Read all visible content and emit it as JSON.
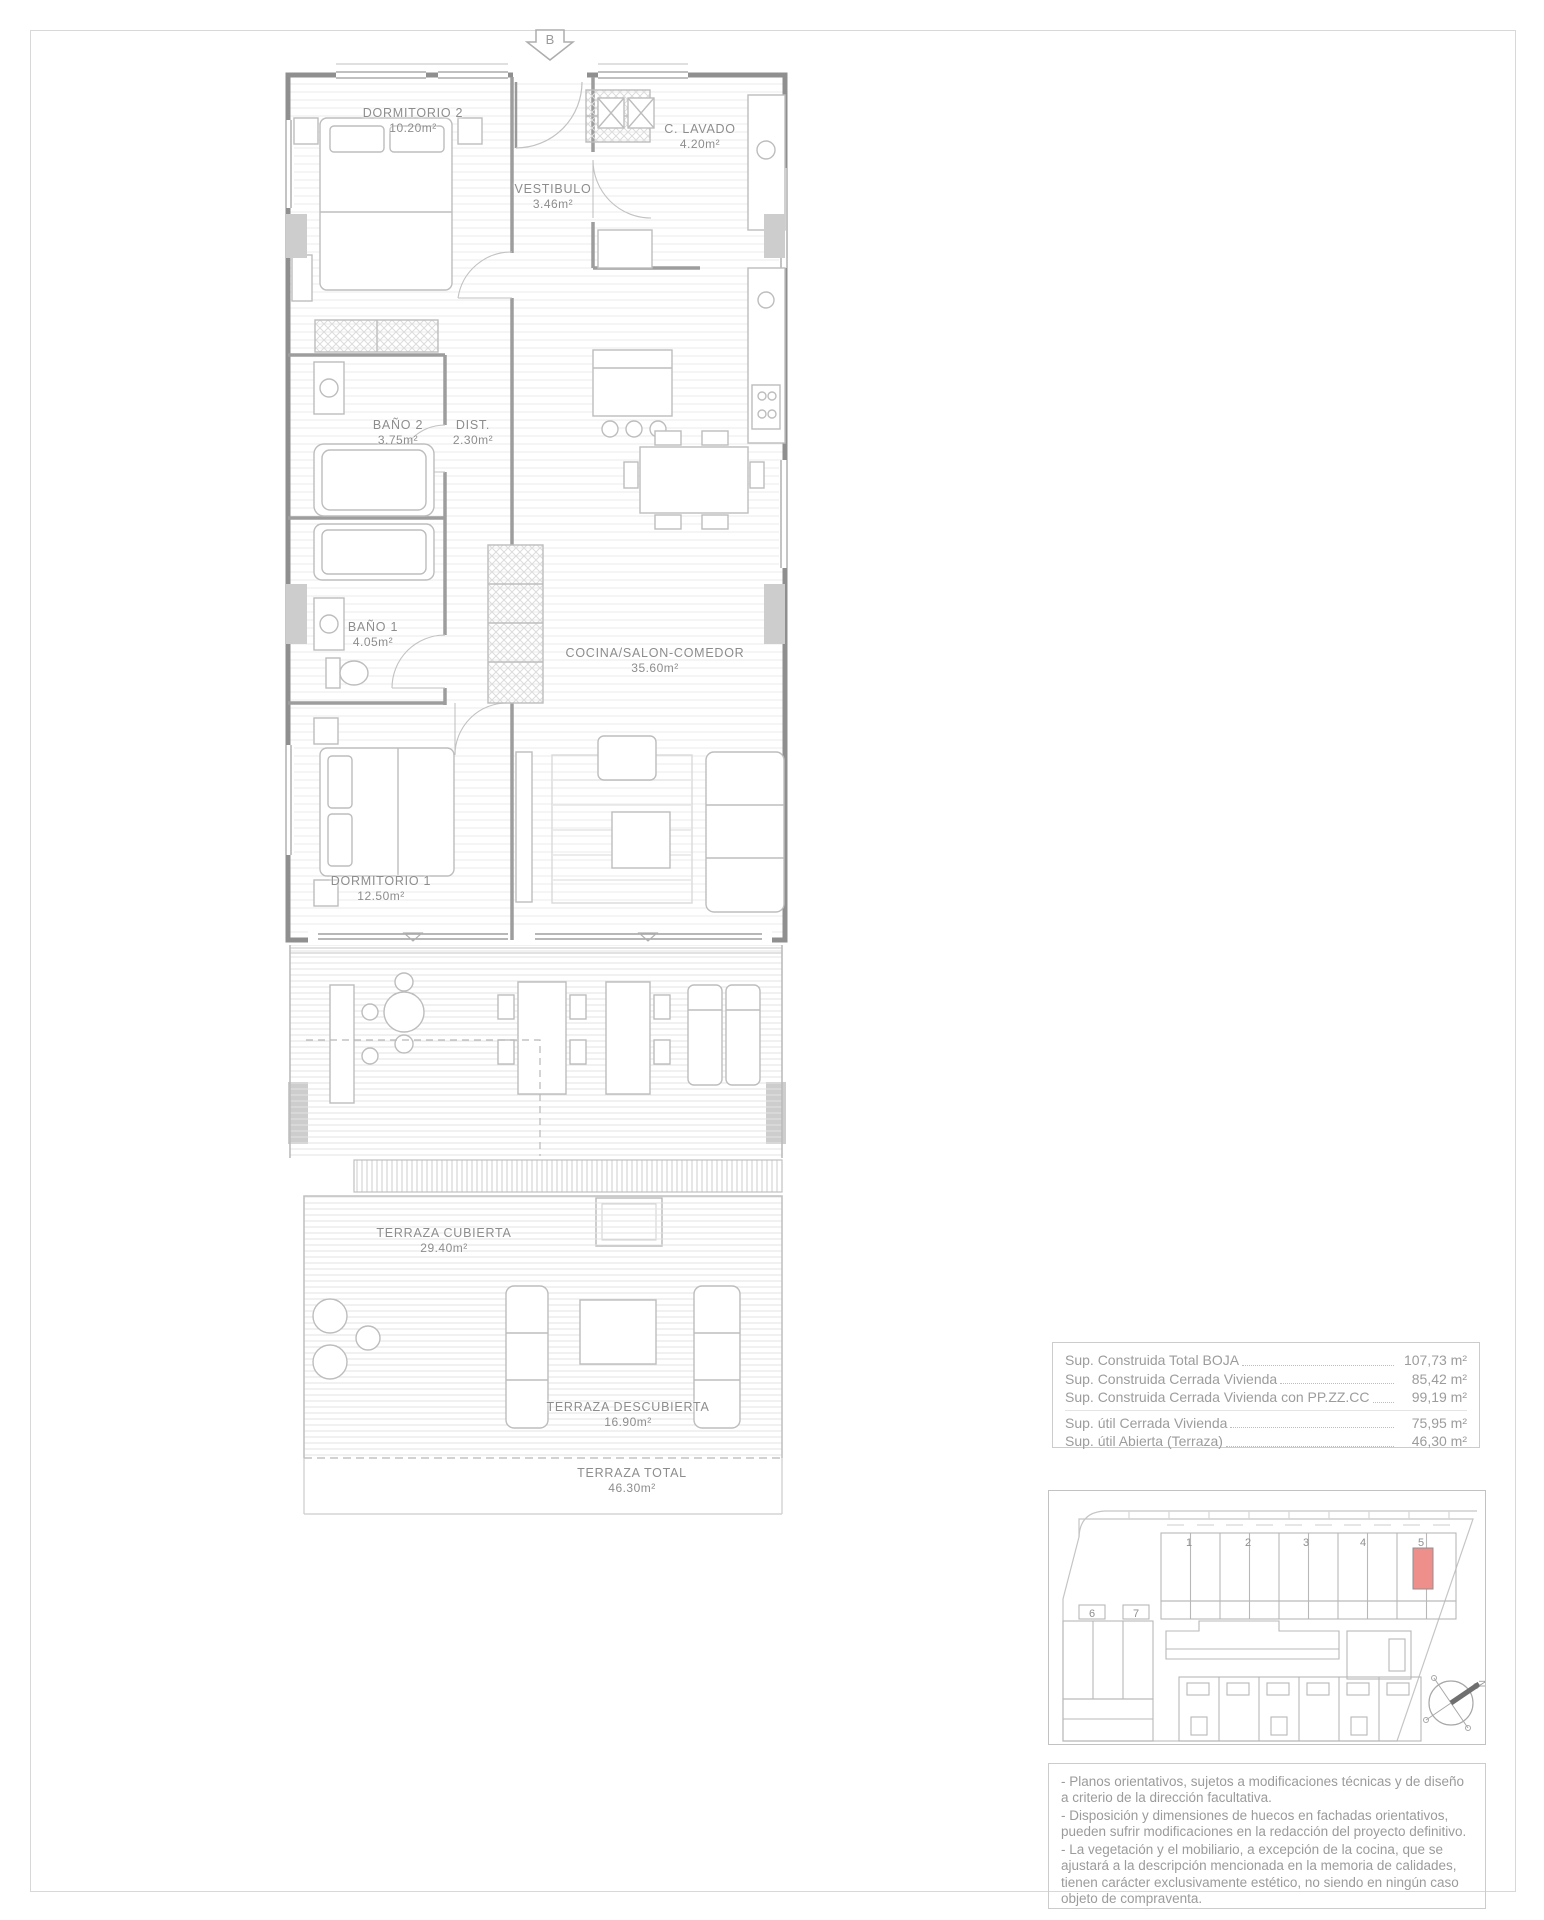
{
  "page": {
    "section_marker": "B",
    "compass_label": "N"
  },
  "rooms": [
    {
      "name": "DORMITORIO 2",
      "area": "10.20m²"
    },
    {
      "name": "VESTIBULO",
      "area": "3.46m²"
    },
    {
      "name": "C. LAVADO",
      "area": "4.20m²"
    },
    {
      "name": "BAÑO 2",
      "area": "3.75m²"
    },
    {
      "name": "DIST.",
      "area": "2.30m²"
    },
    {
      "name": "BAÑO 1",
      "area": "4.05m²"
    },
    {
      "name": "COCINA/SALON-COMEDOR",
      "area": "35.60m²"
    },
    {
      "name": "DORMITORIO 1",
      "area": "12.50m²"
    },
    {
      "name": "TERRAZA CUBIERTA",
      "area": "29.40m²"
    },
    {
      "name": "TERRAZA DESCUBIERTA",
      "area": "16.90m²"
    },
    {
      "name": "TERRAZA TOTAL",
      "area": "46.30m²"
    }
  ],
  "areas_table": {
    "rows": [
      {
        "label": "Sup. Construida Total BOJA",
        "value": "107,73 m²"
      },
      {
        "label": "Sup. Construida Cerrada Vivienda",
        "value": "85,42 m²"
      },
      {
        "label": "Sup. Construida Cerrada Vivienda con PP.ZZ.CC",
        "value": "99,19 m²"
      },
      {
        "label": "Sup. útil Cerrada Vivienda",
        "value": "75,95 m²"
      },
      {
        "label": "Sup. útil Abierta (Terraza)",
        "value": "46,30 m²"
      }
    ]
  },
  "site_plan": {
    "block_numbers": [
      "1",
      "2",
      "3",
      "4",
      "5",
      "6",
      "7"
    ],
    "highlight_color": "#ef8f8c"
  },
  "notes": {
    "lines": [
      "- Planos orientativos, sujetos a modificaciones técnicas y de diseño a criterio de la dirección facultativa.",
      "- Disposición y dimensiones de huecos en fachadas orientativos, pueden sufrir modificaciones en la redacción del proyecto definitivo.",
      "- La vegetación y el mobiliario, a excepción de la cocina, que se ajustará a la descripción mencionada en la memoria de calidades, tienen carácter exclusivamente estético, no siendo en ningún caso objeto de compraventa."
    ]
  },
  "colors": {
    "line": "#9a9a9a",
    "text": "#9b9b9b",
    "highlight": "#ef8f8c"
  }
}
